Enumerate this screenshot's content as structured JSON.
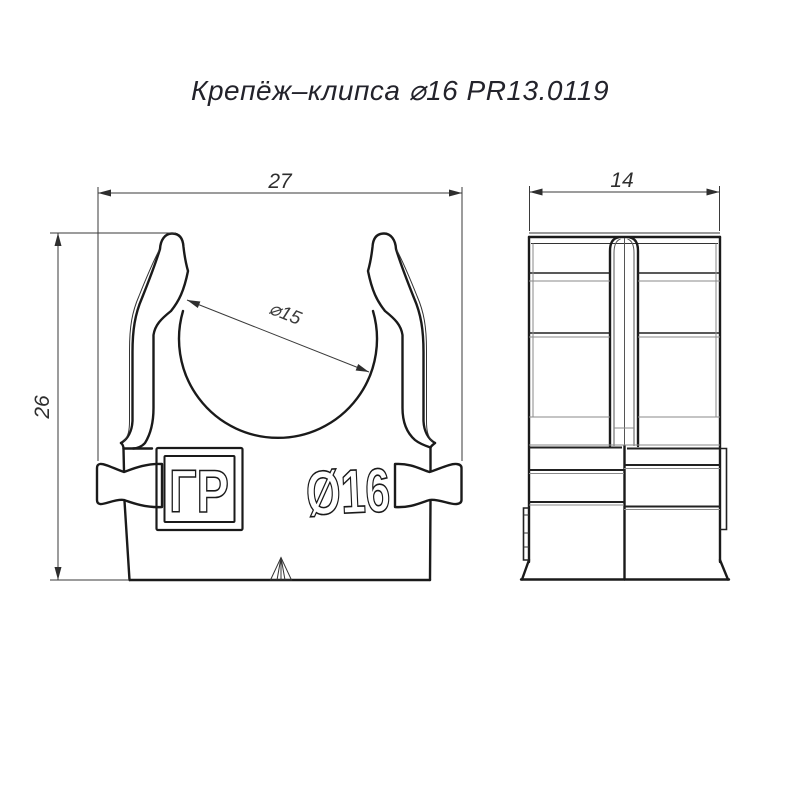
{
  "title": "Крепёж–клипса ⌀16 PR13.0119",
  "front_view": {
    "dim_width": "27",
    "dim_height": "26",
    "dim_inner_diameter": "⌀15",
    "logo_text": "ГР",
    "embossed_size": "Ø16"
  },
  "side_view": {
    "dim_depth": "14"
  },
  "colors": {
    "line": "#1a1a1a",
    "dimension": "#3a3a3a",
    "background": "#ffffff"
  }
}
